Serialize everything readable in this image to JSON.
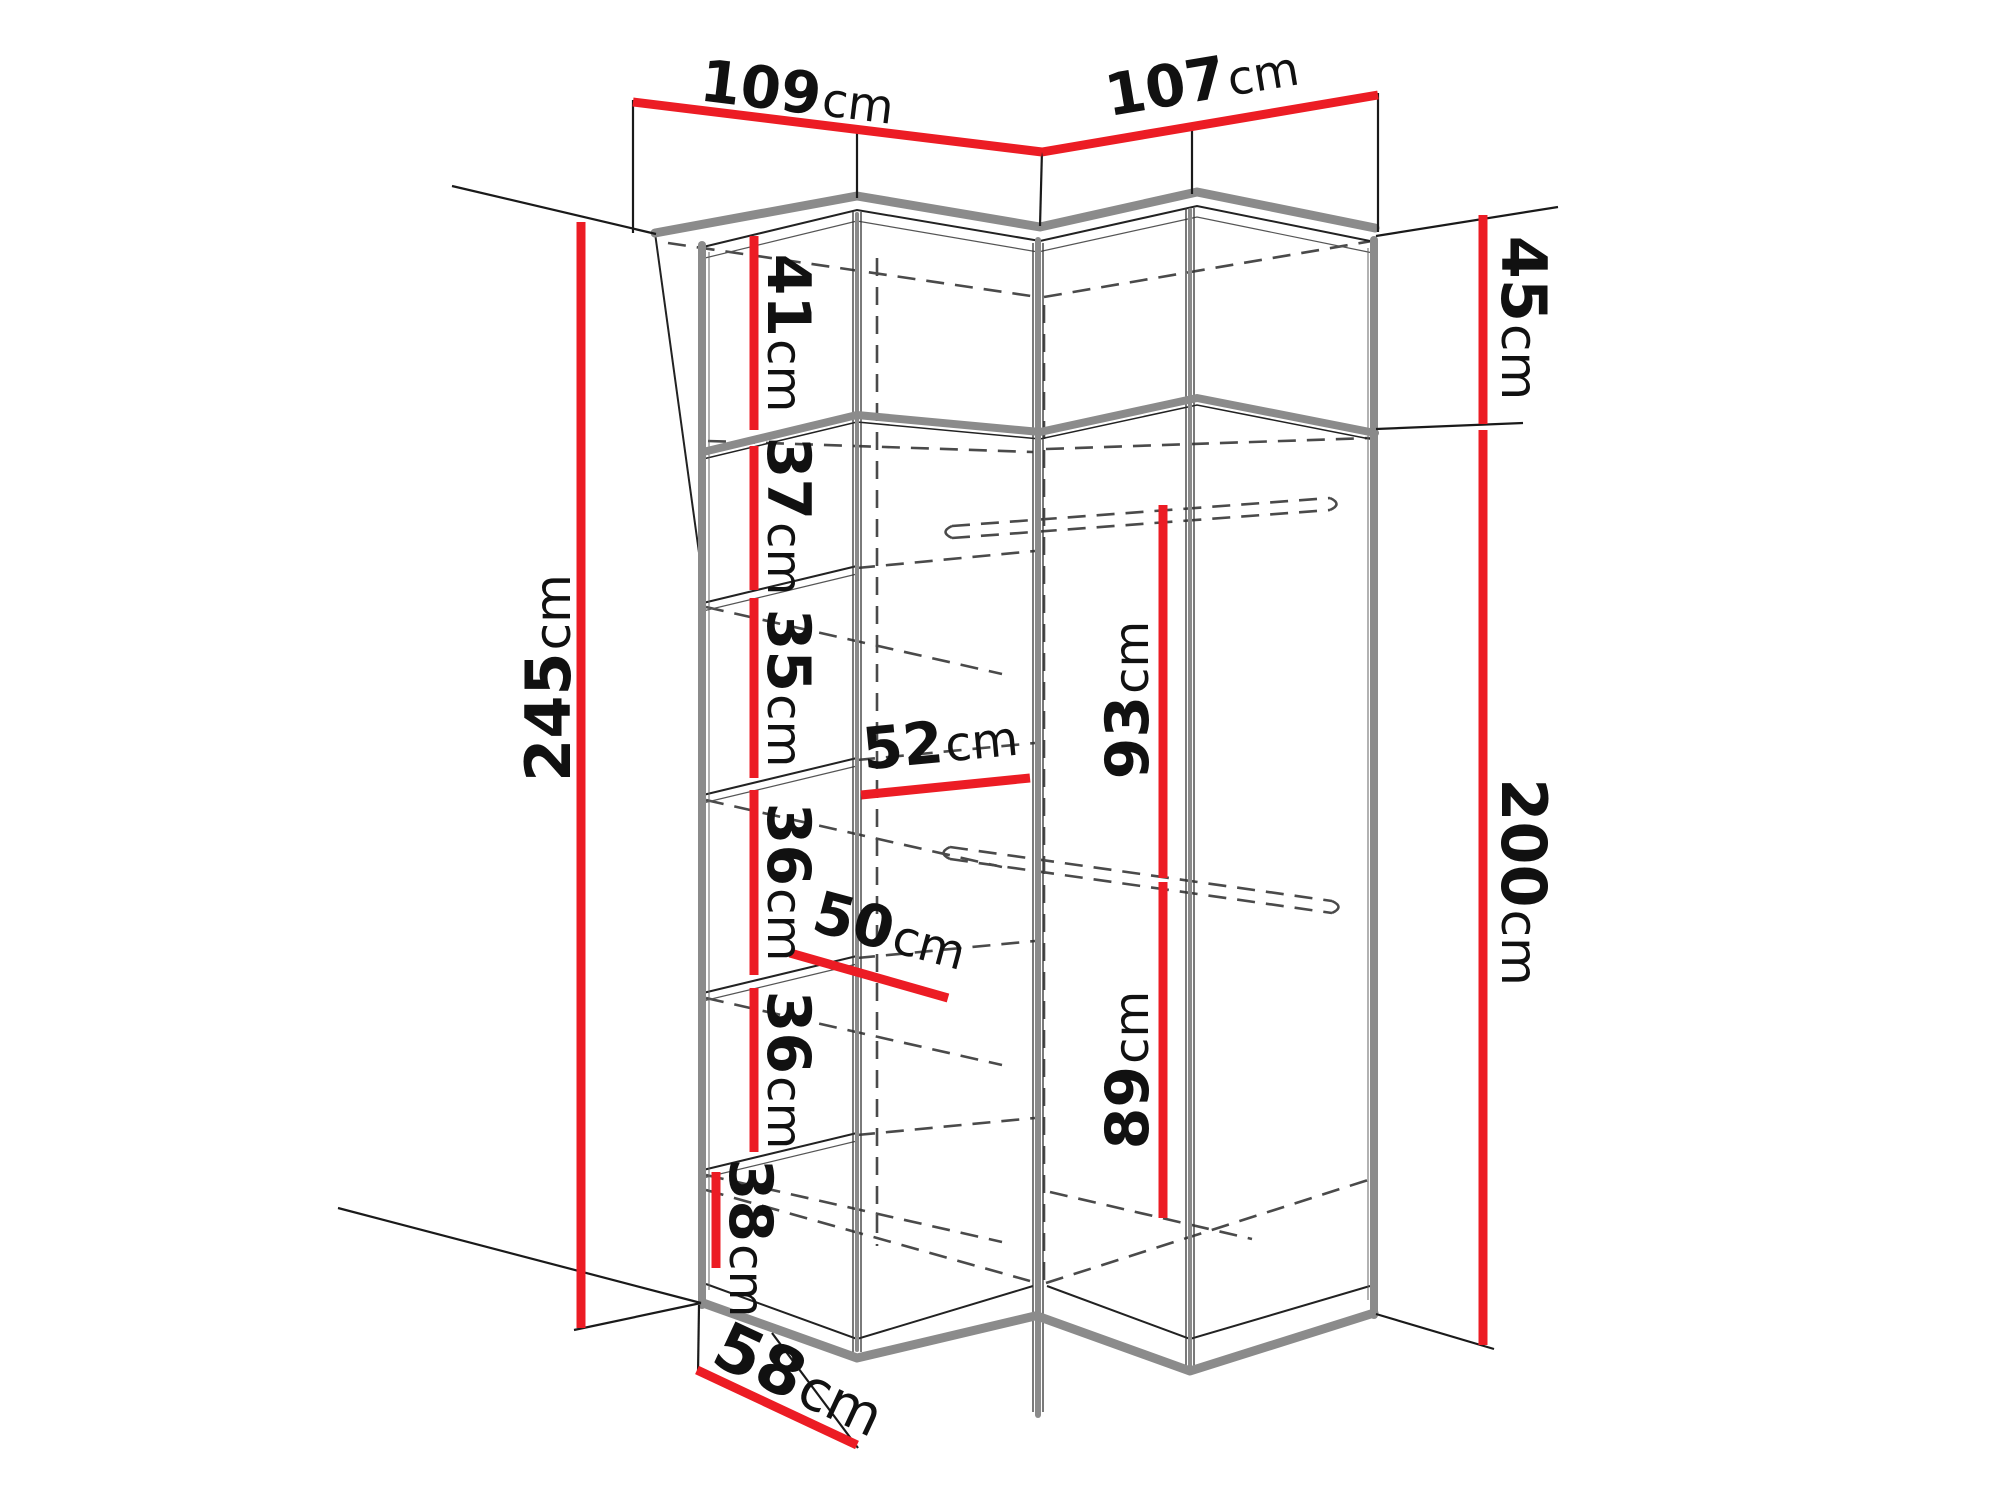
{
  "diagram": {
    "kind": "furniture-dimension-diagram",
    "subject": "corner wardrobe with shelves and hanging rails",
    "unit": "cm"
  },
  "colors": {
    "accent": "#ec1c24",
    "structure": "#8b8b8b",
    "lines": "#222222",
    "hidden": "#4a4a4a",
    "text": "#111111"
  },
  "labels": {
    "top_width_left": {
      "num": "109",
      "unit": "cm"
    },
    "top_width_right": {
      "num": "107",
      "unit": "cm"
    },
    "total_height": {
      "num": "245",
      "unit": "cm"
    },
    "upper_cabinet_height": {
      "num": "45",
      "unit": "cm"
    },
    "main_height": {
      "num": "200",
      "unit": "cm"
    },
    "shelf_gap_1": {
      "num": "41",
      "unit": "cm"
    },
    "shelf_gap_2": {
      "num": "37",
      "unit": "cm"
    },
    "shelf_gap_3": {
      "num": "35",
      "unit": "cm"
    },
    "shelf_gap_4": {
      "num": "36",
      "unit": "cm"
    },
    "shelf_gap_5": {
      "num": "36",
      "unit": "cm"
    },
    "shelf_gap_6": {
      "num": "38",
      "unit": "cm"
    },
    "corner_width": {
      "num": "52",
      "unit": "cm"
    },
    "corner_depth": {
      "num": "50",
      "unit": "cm"
    },
    "hang_height_top": {
      "num": "93",
      "unit": "cm"
    },
    "hang_height_bottom": {
      "num": "89",
      "unit": "cm"
    },
    "side_depth": {
      "num": "58",
      "unit": "cm"
    }
  }
}
